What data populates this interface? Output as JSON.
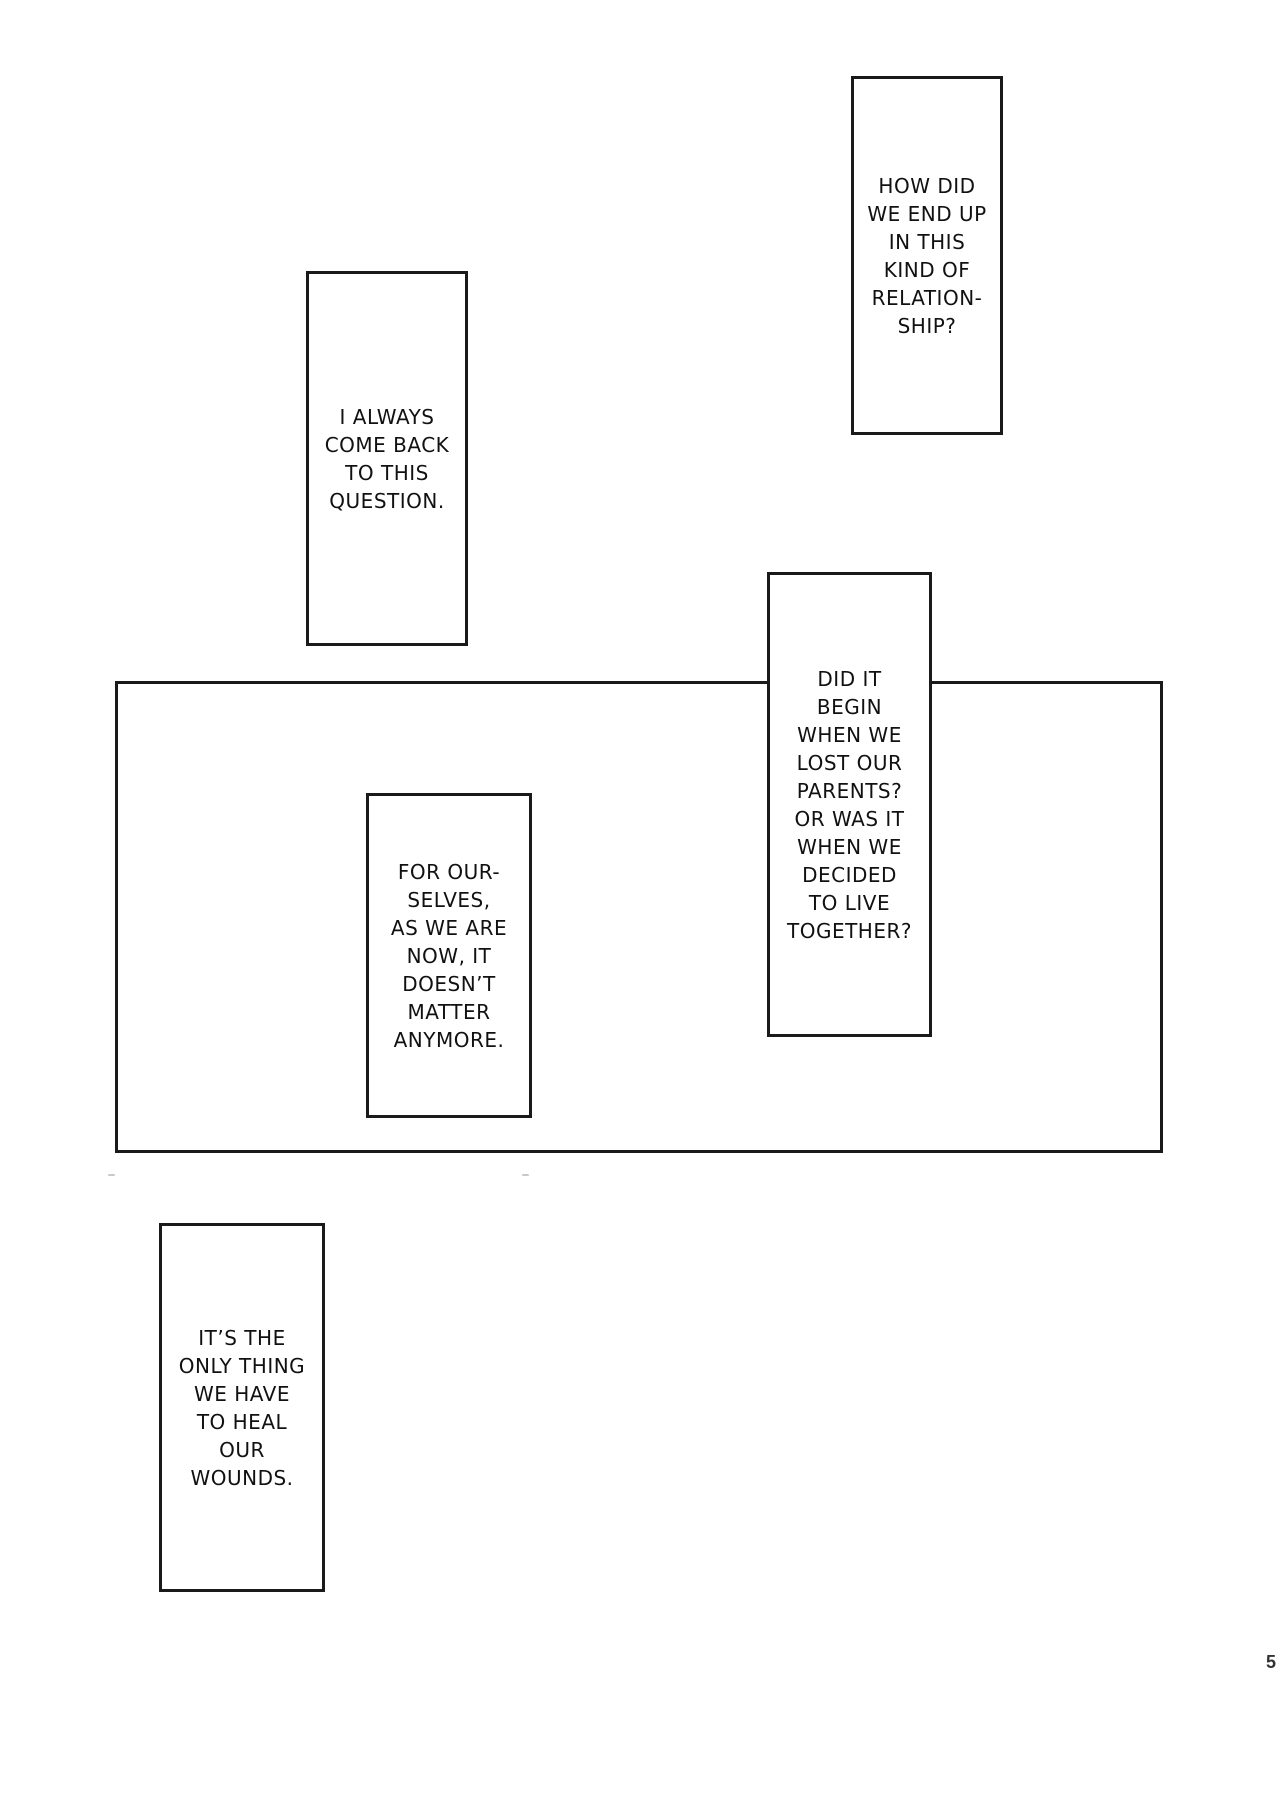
{
  "page": {
    "number": "5",
    "background_color": "#ffffff",
    "line_color": "#1a1a1a",
    "text_color": "#111111"
  },
  "captions": [
    {
      "id": "how-did",
      "text": "HOW DID\nWE END UP\nIN THIS\nKIND OF\nRELATION-\nSHIP?"
    },
    {
      "id": "i-always",
      "text": "I ALWAYS\nCOME BACK\nTO THIS\nQUESTION."
    },
    {
      "id": "did-it-begin",
      "text": "DID IT\nBEGIN\nWHEN WE\nLOST OUR\nPARENTS?\nOR WAS IT\nWHEN WE\nDECIDED\nTO LIVE\nTOGETHER?"
    },
    {
      "id": "for-ourselves",
      "text": "FOR OUR-\nSELVES,\nAS WE ARE\nNOW, IT\nDOESN’T\nMATTER\nANYMORE."
    },
    {
      "id": "its-the-only",
      "text": "IT’S THE\nONLY THING\nWE HAVE\nTO HEAL\nOUR\nWOUNDS."
    }
  ]
}
